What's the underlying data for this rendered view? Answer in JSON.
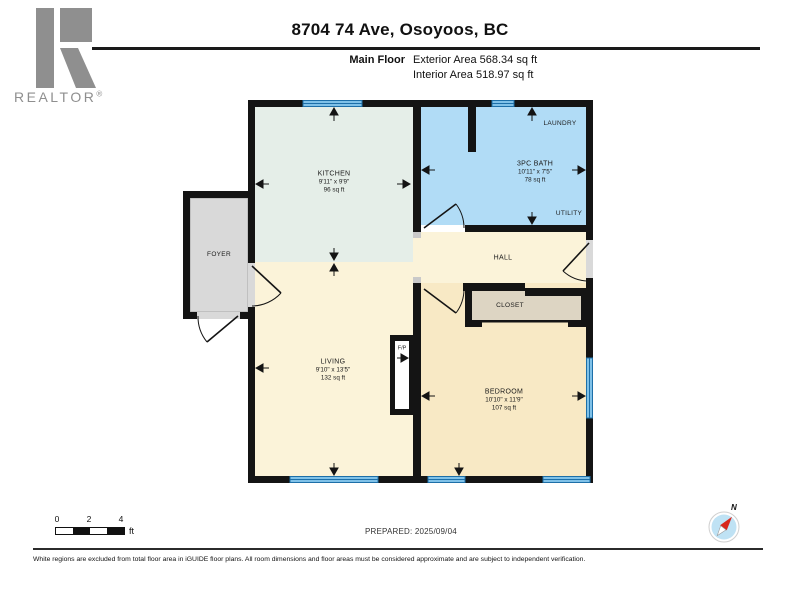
{
  "header": {
    "title": "8704 74 Ave, Osoyoos, BC",
    "floor_label": "Main Floor",
    "exterior_area": "Exterior Area 568.34 sq ft",
    "interior_area": "Interior Area 518.97 sq ft"
  },
  "branding": {
    "logo_text": "REALTOR",
    "logo_reg": "®"
  },
  "rooms": {
    "kitchen": {
      "name": "KITCHEN",
      "dims": "9'11\" x 9'9\"",
      "area": "96 sq ft"
    },
    "bath": {
      "name": "3PC BATH",
      "dims": "10'11\" x 7'5\"",
      "area": "78 sq ft"
    },
    "living": {
      "name": "LIVING",
      "dims": "9'10\" x 13'5\"",
      "area": "132 sq ft"
    },
    "bedroom": {
      "name": "BEDROOM",
      "dims": "10'10\" x 11'9\"",
      "area": "107 sq ft"
    },
    "foyer": {
      "name": "FOYER"
    },
    "hall": {
      "name": "HALL"
    },
    "closet": {
      "name": "CLOSET"
    },
    "laundry": {
      "name": "LAUNDRY"
    },
    "utility": {
      "name": "UTILITY"
    },
    "fireplace": {
      "name": "F/P"
    }
  },
  "footer": {
    "scale": {
      "tick0": "0",
      "tick2": "2",
      "tick4": "4",
      "unit": "ft"
    },
    "prepared": "PREPARED: 2025/09/04",
    "compass_label": "N",
    "disclaimer": "White regions are excluded from total floor area in iGUIDE floor plans. All room dimensions and floor areas must be considered approximate and are subject to independent verification."
  },
  "colors": {
    "wall": "#141414",
    "kitchen": "#e5eee8",
    "bath": "#b1dcf6",
    "living": "#fbf3d9",
    "hall": "#fbf3d9",
    "bedroom": "#f8e9c5",
    "closet": "#ddd5c3",
    "foyer": "#d9d9d9",
    "threshold": "#d9d9d9",
    "window_fill": "#7fc1e8",
    "window_edge": "#1d6fa8",
    "logo_gray": "#8f8f8f",
    "compass_blue": "#bfe2f4",
    "needle_red": "#d8271c"
  }
}
